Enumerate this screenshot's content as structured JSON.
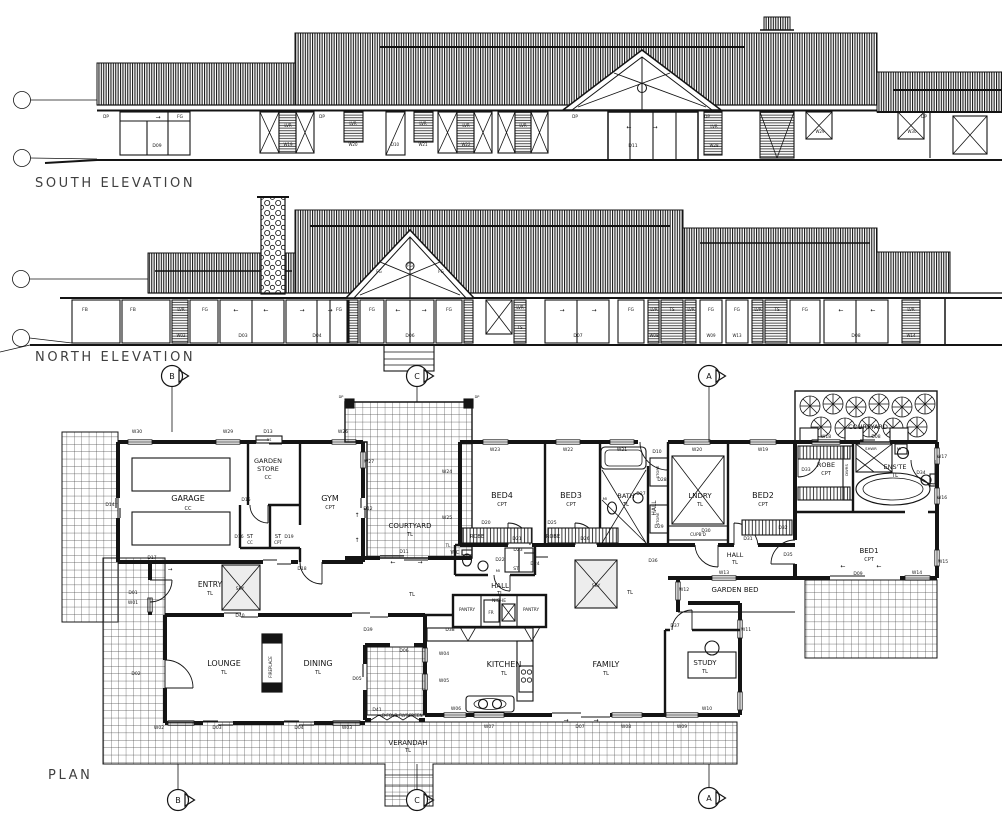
{
  "titles": {
    "south": "SOUTH ELEVATION",
    "north": "NORTH ELEVATION",
    "plan": "PLAN"
  },
  "markers": [
    {
      "l": "B",
      "x": 172,
      "y": 376
    },
    {
      "l": "C",
      "x": 417,
      "y": 376
    },
    {
      "l": "A",
      "x": 709,
      "y": 376
    },
    {
      "l": "B",
      "x": 178,
      "y": 800
    },
    {
      "l": "C",
      "x": 417,
      "y": 800
    },
    {
      "l": "A",
      "x": 709,
      "y": 798
    }
  ],
  "south_elevation": {
    "tags": [
      {
        "t": "DP",
        "x": 106,
        "y": 118,
        "s": 4.2
      },
      {
        "t": "→",
        "x": 158,
        "y": 119,
        "s": 6
      },
      {
        "t": "FG",
        "x": 180,
        "y": 118,
        "s": 4.5
      },
      {
        "t": "D09",
        "x": 157,
        "y": 147,
        "s": 4.5
      },
      {
        "t": "LVR",
        "x": 288,
        "y": 127,
        "s": 4
      },
      {
        "t": "W19",
        "x": 288,
        "y": 146,
        "s": 4
      },
      {
        "t": "DP",
        "x": 322,
        "y": 118,
        "s": 4.2
      },
      {
        "t": "LVR",
        "x": 353,
        "y": 125,
        "s": 4
      },
      {
        "t": "W20",
        "x": 353,
        "y": 146,
        "s": 4
      },
      {
        "t": "D10",
        "x": 395,
        "y": 146,
        "s": 4
      },
      {
        "t": "LVR",
        "x": 423,
        "y": 125,
        "s": 4
      },
      {
        "t": "W21",
        "x": 423,
        "y": 146,
        "s": 4
      },
      {
        "t": "LVR",
        "x": 466,
        "y": 127,
        "s": 4
      },
      {
        "t": "W22",
        "x": 466,
        "y": 146,
        "s": 4
      },
      {
        "t": "LVR",
        "x": 523,
        "y": 127,
        "s": 4
      },
      {
        "t": "DP",
        "x": 575,
        "y": 118,
        "s": 4.2
      },
      {
        "t": "←",
        "x": 629,
        "y": 129,
        "s": 6
      },
      {
        "t": "→",
        "x": 655,
        "y": 129,
        "s": 6
      },
      {
        "t": "D11",
        "x": 633,
        "y": 147,
        "s": 4.5
      },
      {
        "t": "DP",
        "x": 707,
        "y": 118,
        "s": 4.2
      },
      {
        "t": "LVR",
        "x": 714,
        "y": 128,
        "s": 4
      },
      {
        "t": "W28",
        "x": 714,
        "y": 147,
        "s": 4
      },
      {
        "t": "W29",
        "x": 820,
        "y": 133,
        "s": 4
      },
      {
        "t": "DP",
        "x": 924,
        "y": 118,
        "s": 4.2
      },
      {
        "t": "W30",
        "x": 912,
        "y": 133,
        "s": 4
      }
    ]
  },
  "north_elevation": {
    "tags": [
      {
        "t": "FB",
        "x": 85,
        "y": 311,
        "s": 4.5
      },
      {
        "t": "FB",
        "x": 133,
        "y": 311,
        "s": 4.5
      },
      {
        "t": "LVR",
        "x": 181,
        "y": 311,
        "s": 4
      },
      {
        "t": "W02",
        "x": 181,
        "y": 337,
        "s": 4
      },
      {
        "t": "FG",
        "x": 205,
        "y": 311,
        "s": 4.5
      },
      {
        "t": "←",
        "x": 236,
        "y": 312,
        "s": 6
      },
      {
        "t": "←",
        "x": 266,
        "y": 312,
        "s": 6
      },
      {
        "t": "D03",
        "x": 243,
        "y": 337,
        "s": 4.5
      },
      {
        "t": "→",
        "x": 302,
        "y": 312,
        "s": 6
      },
      {
        "t": "→",
        "x": 330,
        "y": 312,
        "s": 6
      },
      {
        "t": "D04",
        "x": 317,
        "y": 337,
        "s": 4.5
      },
      {
        "t": "FG",
        "x": 339,
        "y": 311,
        "s": 4.5
      },
      {
        "t": "FG",
        "x": 379,
        "y": 273,
        "s": 4
      },
      {
        "t": "FG",
        "x": 410,
        "y": 267,
        "s": 4
      },
      {
        "t": "FG",
        "x": 441,
        "y": 273,
        "s": 4
      },
      {
        "t": "FG",
        "x": 372,
        "y": 311,
        "s": 4.5
      },
      {
        "t": "←",
        "x": 398,
        "y": 312,
        "s": 6
      },
      {
        "t": "→",
        "x": 424,
        "y": 312,
        "s": 6
      },
      {
        "t": "D06",
        "x": 410,
        "y": 337,
        "s": 4.5
      },
      {
        "t": "FG",
        "x": 449,
        "y": 311,
        "s": 4.5
      },
      {
        "t": "LVR",
        "x": 520,
        "y": 309,
        "s": 4
      },
      {
        "t": "TS",
        "x": 520,
        "y": 329,
        "s": 4
      },
      {
        "t": "→",
        "x": 562,
        "y": 312,
        "s": 6
      },
      {
        "t": "→",
        "x": 594,
        "y": 312,
        "s": 6
      },
      {
        "t": "D07",
        "x": 578,
        "y": 337,
        "s": 4.5
      },
      {
        "t": "FG",
        "x": 631,
        "y": 311,
        "s": 4.5
      },
      {
        "t": "LVR",
        "x": 654,
        "y": 311,
        "s": 4
      },
      {
        "t": "TS",
        "x": 672,
        "y": 311,
        "s": 4
      },
      {
        "t": "LVR",
        "x": 691,
        "y": 311,
        "s": 4
      },
      {
        "t": "W08",
        "x": 654,
        "y": 337,
        "s": 4
      },
      {
        "t": "FG",
        "x": 711,
        "y": 311,
        "s": 4.5
      },
      {
        "t": "W09",
        "x": 711,
        "y": 337,
        "s": 4
      },
      {
        "t": "FG",
        "x": 737,
        "y": 311,
        "s": 4.5
      },
      {
        "t": "W13",
        "x": 737,
        "y": 337,
        "s": 4
      },
      {
        "t": "LVR",
        "x": 758,
        "y": 311,
        "s": 4
      },
      {
        "t": "TS",
        "x": 777,
        "y": 311,
        "s": 4
      },
      {
        "t": "FG",
        "x": 805,
        "y": 311,
        "s": 4.5
      },
      {
        "t": "←",
        "x": 841,
        "y": 312,
        "s": 6
      },
      {
        "t": "←",
        "x": 873,
        "y": 312,
        "s": 6
      },
      {
        "t": "D08",
        "x": 856,
        "y": 337,
        "s": 4.5
      },
      {
        "t": "LVR",
        "x": 911,
        "y": 311,
        "s": 4
      },
      {
        "t": "W14",
        "x": 911,
        "y": 337,
        "s": 4
      }
    ]
  },
  "plan": {
    "rooms": [
      {
        "t": "GARAGE",
        "x": 188,
        "y": 501
      },
      {
        "t": "GYM",
        "x": 330,
        "y": 501
      },
      {
        "t": "ENTRY",
        "x": 210,
        "y": 587,
        "s": 7.5
      },
      {
        "t": "GARDEN",
        "x": 268,
        "y": 463,
        "s": 6.5
      },
      {
        "t": "STORE",
        "x": 268,
        "y": 471,
        "s": 6.5
      },
      {
        "t": "COURTYARD",
        "x": 410,
        "y": 528,
        "s": 7
      },
      {
        "t": "COURTYARD",
        "x": 868,
        "y": 429,
        "s": 6.5
      },
      {
        "t": "BED4",
        "x": 502,
        "y": 498
      },
      {
        "t": "BED3",
        "x": 571,
        "y": 498
      },
      {
        "t": "BATH",
        "x": 626,
        "y": 498,
        "s": 6.5
      },
      {
        "t": "LNDRY",
        "x": 700,
        "y": 498,
        "s": 7
      },
      {
        "t": "BED2",
        "x": 763,
        "y": 498
      },
      {
        "t": "ROBE",
        "x": 826,
        "y": 467,
        "s": 6.5
      },
      {
        "t": "ENS'TE",
        "x": 895,
        "y": 469,
        "s": 6.5
      },
      {
        "t": "BED1",
        "x": 869,
        "y": 553,
        "s": 7
      },
      {
        "t": "HALL",
        "x": 500,
        "y": 588,
        "s": 7
      },
      {
        "t": "HALL",
        "x": 735,
        "y": 557,
        "s": 6.5
      },
      {
        "t": "HALL",
        "x": 656,
        "y": 508,
        "s": 6,
        "v": true
      },
      {
        "t": "WC",
        "x": 455,
        "y": 554,
        "s": 5.5
      },
      {
        "t": "LOUNGE",
        "x": 224,
        "y": 666
      },
      {
        "t": "DINING",
        "x": 318,
        "y": 666
      },
      {
        "t": "KITCHEN",
        "x": 504,
        "y": 667
      },
      {
        "t": "FAMILY",
        "x": 606,
        "y": 667
      },
      {
        "t": "STUDY",
        "x": 705,
        "y": 665,
        "s": 7
      },
      {
        "t": "VERANDAH",
        "x": 408,
        "y": 745,
        "s": 7
      },
      {
        "t": "GARDEN BED",
        "x": 735,
        "y": 592,
        "s": 7
      }
    ],
    "finishes": [
      {
        "t": "CC",
        "x": 188,
        "y": 510
      },
      {
        "t": "CPT",
        "x": 330,
        "y": 509
      },
      {
        "t": "TL",
        "x": 210,
        "y": 595
      },
      {
        "t": "CC",
        "x": 268,
        "y": 479
      },
      {
        "t": "TL",
        "x": 410,
        "y": 536
      },
      {
        "t": "CPT",
        "x": 502,
        "y": 506
      },
      {
        "t": "CPT",
        "x": 571,
        "y": 506
      },
      {
        "t": "TL",
        "x": 626,
        "y": 506
      },
      {
        "t": "TL",
        "x": 700,
        "y": 506
      },
      {
        "t": "CPT",
        "x": 763,
        "y": 506
      },
      {
        "t": "CPT",
        "x": 826,
        "y": 475
      },
      {
        "t": "TL",
        "x": 895,
        "y": 477
      },
      {
        "t": "CPT",
        "x": 869,
        "y": 561
      },
      {
        "t": "TL",
        "x": 500,
        "y": 595
      },
      {
        "t": "TL",
        "x": 735,
        "y": 564
      },
      {
        "t": "TL",
        "x": 448,
        "y": 547,
        "s": 4
      },
      {
        "t": "TL",
        "x": 224,
        "y": 674
      },
      {
        "t": "TL",
        "x": 318,
        "y": 674
      },
      {
        "t": "TL",
        "x": 504,
        "y": 675
      },
      {
        "t": "TL",
        "x": 606,
        "y": 675
      },
      {
        "t": "TL",
        "x": 705,
        "y": 673
      },
      {
        "t": "TL",
        "x": 408,
        "y": 752
      },
      {
        "t": "TL",
        "x": 412,
        "y": 596
      },
      {
        "t": "TL",
        "x": 630,
        "y": 594
      },
      {
        "t": "CC",
        "x": 250,
        "y": 544,
        "s": 4
      },
      {
        "t": "CPT",
        "x": 278,
        "y": 544,
        "s": 4
      }
    ],
    "doors": [
      {
        "t": "D01",
        "x": 133,
        "y": 594
      },
      {
        "t": "D02",
        "x": 136,
        "y": 675
      },
      {
        "t": "D03",
        "x": 217,
        "y": 729
      },
      {
        "t": "D04",
        "x": 299,
        "y": 729
      },
      {
        "t": "D05",
        "x": 357,
        "y": 680
      },
      {
        "t": "D06",
        "x": 404,
        "y": 652
      },
      {
        "t": "D07",
        "x": 580,
        "y": 728
      },
      {
        "t": "D08",
        "x": 876,
        "y": 438
      },
      {
        "t": "D09",
        "x": 858,
        "y": 575
      },
      {
        "t": "D10",
        "x": 657,
        "y": 453
      },
      {
        "t": "D11",
        "x": 404,
        "y": 553
      },
      {
        "t": "D12",
        "x": 368,
        "y": 510
      },
      {
        "t": "D13",
        "x": 268,
        "y": 433
      },
      {
        "t": "D14",
        "x": 110,
        "y": 506
      },
      {
        "t": "D15",
        "x": 246,
        "y": 501
      },
      {
        "t": "D16",
        "x": 239,
        "y": 538
      },
      {
        "t": "D17",
        "x": 152,
        "y": 559
      },
      {
        "t": "D18",
        "x": 302,
        "y": 570
      },
      {
        "t": "D19",
        "x": 289,
        "y": 538
      },
      {
        "t": "D20",
        "x": 486,
        "y": 524
      },
      {
        "t": "D21",
        "x": 517,
        "y": 540
      },
      {
        "t": "D22",
        "x": 500,
        "y": 561
      },
      {
        "t": "D23",
        "x": 518,
        "y": 551
      },
      {
        "t": "D24",
        "x": 535,
        "y": 565
      },
      {
        "t": "D25",
        "x": 552,
        "y": 524
      },
      {
        "t": "D26",
        "x": 585,
        "y": 540
      },
      {
        "t": "D27",
        "x": 641,
        "y": 495
      },
      {
        "t": "D28",
        "x": 662,
        "y": 481
      },
      {
        "t": "D29",
        "x": 659,
        "y": 528
      },
      {
        "t": "D30",
        "x": 706,
        "y": 532
      },
      {
        "t": "D31",
        "x": 748,
        "y": 540
      },
      {
        "t": "D32",
        "x": 783,
        "y": 529
      },
      {
        "t": "D33",
        "x": 806,
        "y": 471
      },
      {
        "t": "D34",
        "x": 921,
        "y": 474
      },
      {
        "t": "D35",
        "x": 788,
        "y": 556
      },
      {
        "t": "D36",
        "x": 653,
        "y": 562
      },
      {
        "t": "D37",
        "x": 675,
        "y": 627
      },
      {
        "t": "D38",
        "x": 450,
        "y": 631
      },
      {
        "t": "D39",
        "x": 368,
        "y": 631
      },
      {
        "t": "D40",
        "x": 240,
        "y": 617
      },
      {
        "t": "D41",
        "x": 377,
        "y": 711
      }
    ],
    "windows": [
      {
        "t": "W01",
        "x": 133,
        "y": 604
      },
      {
        "t": "W02",
        "x": 159,
        "y": 729
      },
      {
        "t": "W03",
        "x": 347,
        "y": 729
      },
      {
        "t": "W04",
        "x": 444,
        "y": 655
      },
      {
        "t": "W05",
        "x": 444,
        "y": 682
      },
      {
        "t": "W06",
        "x": 456,
        "y": 710
      },
      {
        "t": "W07",
        "x": 489,
        "y": 728
      },
      {
        "t": "W08",
        "x": 626,
        "y": 728
      },
      {
        "t": "W09",
        "x": 682,
        "y": 728
      },
      {
        "t": "W10",
        "x": 707,
        "y": 710
      },
      {
        "t": "W11",
        "x": 746,
        "y": 631
      },
      {
        "t": "W12",
        "x": 684,
        "y": 591
      },
      {
        "t": "W13",
        "x": 724,
        "y": 574
      },
      {
        "t": "W14",
        "x": 917,
        "y": 574
      },
      {
        "t": "W15",
        "x": 943,
        "y": 563
      },
      {
        "t": "W16",
        "x": 942,
        "y": 499
      },
      {
        "t": "W17",
        "x": 942,
        "y": 458
      },
      {
        "t": "W18",
        "x": 826,
        "y": 438
      },
      {
        "t": "W19",
        "x": 763,
        "y": 451
      },
      {
        "t": "W20",
        "x": 697,
        "y": 451
      },
      {
        "t": "W21",
        "x": 622,
        "y": 451
      },
      {
        "t": "W22",
        "x": 568,
        "y": 451
      },
      {
        "t": "W23",
        "x": 495,
        "y": 451
      },
      {
        "t": "W24",
        "x": 447,
        "y": 473
      },
      {
        "t": "W25",
        "x": 447,
        "y": 519
      },
      {
        "t": "W26",
        "x": 343,
        "y": 433
      },
      {
        "t": "W27",
        "x": 369,
        "y": 463
      },
      {
        "t": "W29",
        "x": 228,
        "y": 433
      },
      {
        "t": "W30",
        "x": 137,
        "y": 433
      }
    ],
    "misc": [
      {
        "t": "SKY",
        "x": 240,
        "y": 590,
        "s": 4.5
      },
      {
        "t": "SKY",
        "x": 596,
        "y": 587,
        "s": 4.5
      },
      {
        "t": "NICHE",
        "x": 499,
        "y": 602,
        "s": 4.5
      },
      {
        "t": "PANTRY",
        "x": 467,
        "y": 611,
        "s": 4.2
      },
      {
        "t": "PANTRY",
        "x": 531,
        "y": 611,
        "s": 4.2
      },
      {
        "t": "FR",
        "x": 491,
        "y": 614,
        "s": 4.2
      },
      {
        "t": "ROBE",
        "x": 477,
        "y": 538,
        "s": 5
      },
      {
        "t": "ROBE",
        "x": 553,
        "y": 538,
        "s": 5
      },
      {
        "t": "ST",
        "x": 516,
        "y": 570,
        "s": 4.5
      },
      {
        "t": "MI",
        "x": 498,
        "y": 572,
        "s": 3.8
      },
      {
        "t": "ST",
        "x": 250,
        "y": 538,
        "s": 5
      },
      {
        "t": "ST",
        "x": 278,
        "y": 538,
        "s": 5
      },
      {
        "t": "MI",
        "x": 605,
        "y": 500,
        "s": 3.8
      },
      {
        "t": "MI",
        "x": 899,
        "y": 450,
        "s": 3.8
      },
      {
        "t": "SHWR",
        "x": 871,
        "y": 450,
        "s": 3.8
      },
      {
        "t": "DWRS",
        "x": 848,
        "y": 470,
        "s": 3.8,
        "v": true
      },
      {
        "t": "STORE",
        "x": 659,
        "y": 472,
        "s": 3.8,
        "v": true
      },
      {
        "t": "STORE",
        "x": 659,
        "y": 519,
        "s": 3.8,
        "v": true
      },
      {
        "t": "CUPB'D",
        "x": 698,
        "y": 536,
        "s": 4.2
      },
      {
        "t": "FIREPLACE",
        "x": 272,
        "y": 667,
        "s": 4,
        "v": true
      },
      {
        "t": "RS",
        "x": 269,
        "y": 441,
        "s": 3.5
      },
      {
        "t": "B-FOLD FLYSCREEN",
        "x": 382,
        "y": 717,
        "s": 4.2,
        "a": "start"
      },
      {
        "t": "DP",
        "x": 341,
        "y": 398,
        "s": 3.5
      },
      {
        "t": "DP",
        "x": 477,
        "y": 398,
        "s": 3.5
      }
    ],
    "arrows": [
      {
        "t": "→",
        "x": 170,
        "y": 571,
        "s": 5.5
      },
      {
        "t": "↑",
        "x": 357,
        "y": 517,
        "s": 6
      },
      {
        "t": "↑",
        "x": 357,
        "y": 542,
        "s": 6
      },
      {
        "t": "←",
        "x": 393,
        "y": 564,
        "s": 6
      },
      {
        "t": "→",
        "x": 420,
        "y": 564,
        "s": 6
      },
      {
        "t": "→",
        "x": 566,
        "y": 722,
        "s": 6
      },
      {
        "t": "→",
        "x": 596,
        "y": 722,
        "s": 6
      },
      {
        "t": "←",
        "x": 843,
        "y": 568,
        "s": 6
      },
      {
        "t": "←",
        "x": 879,
        "y": 568,
        "s": 6
      }
    ]
  }
}
